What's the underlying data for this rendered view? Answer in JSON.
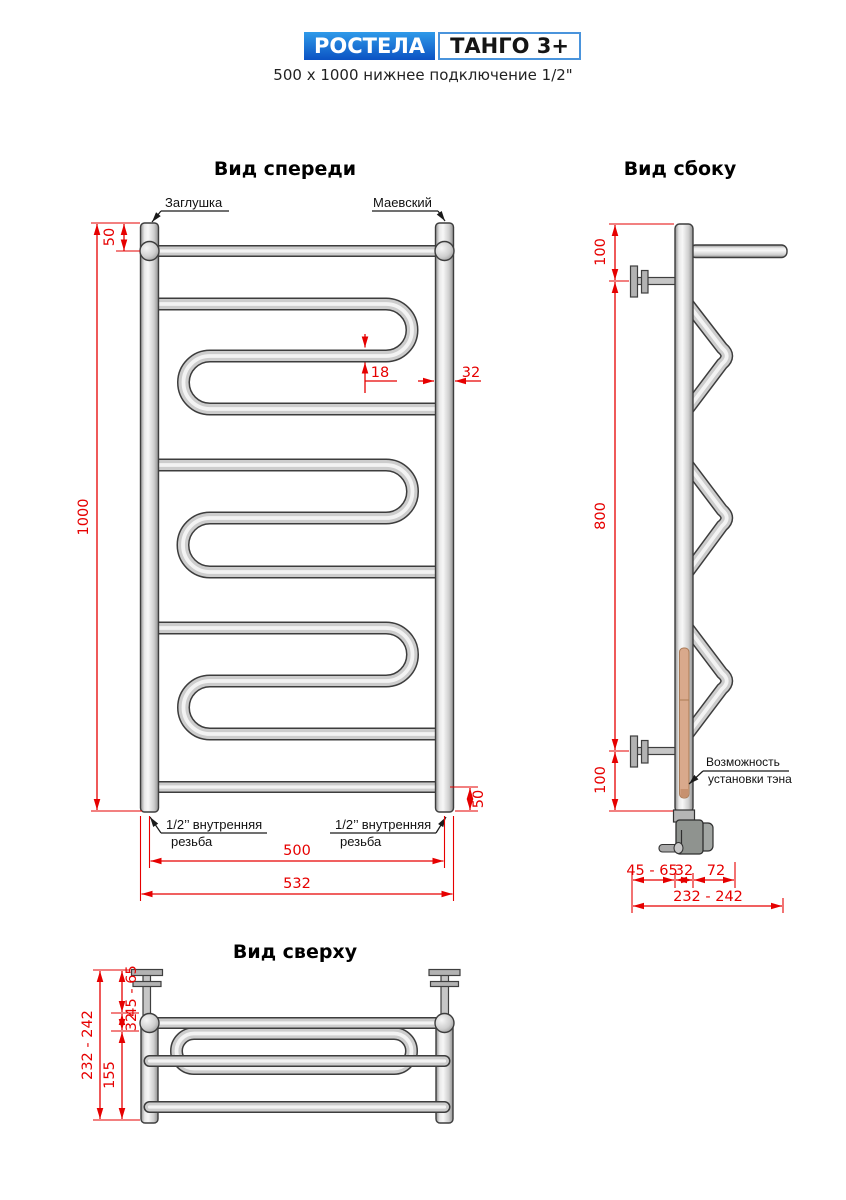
{
  "header": {
    "brand": "РОСТЕЛА",
    "model": "ТАНГО 3+",
    "subtitle": "500 x 1000 нижнее подключение 1/2\""
  },
  "front_view": {
    "title": "Вид спереди",
    "labels": {
      "plug": "Заглушка",
      "air_valve": "Маевский",
      "thread_line1": "1/2’’ внутренняя",
      "thread_line2": "резьба"
    },
    "dims": {
      "top_offset": "50",
      "height": "1000",
      "tube_diameter": "18",
      "riser_diameter": "32",
      "bottom_offset": "50",
      "axis_width": "500",
      "overall_width": "532"
    }
  },
  "side_view": {
    "title": "Вид сбоку",
    "labels": {
      "heater_line1": "Возможность",
      "heater_line2": "установки тэна"
    },
    "dims": {
      "top_offset": "100",
      "bracket_span": "800",
      "bottom_offset": "100",
      "wall_gap": "45 - 65",
      "riser_diameter": "32",
      "loop_depth": "72",
      "overall_depth": "232 - 242"
    }
  },
  "top_view": {
    "title": "Вид сверху",
    "dims": {
      "overall_depth": "232 - 242",
      "wall_gap": "45 - 65",
      "riser_diameter": "32",
      "front_depth": "155"
    }
  },
  "colors": {
    "dimension_red": "#e60000",
    "outline": "#3d3d3d",
    "pipe_light": "#f5f5f5",
    "pipe_mid": "#cdcdcd",
    "pipe_dark": "#8f8f8f",
    "brand_blue_top": "#2f9ae9",
    "brand_blue_bottom": "#0b52c3",
    "model_border_blue": "#4a94dc",
    "heater_rod_copper": "#d9a98c",
    "heater_housing_gray": "#8f938f"
  }
}
